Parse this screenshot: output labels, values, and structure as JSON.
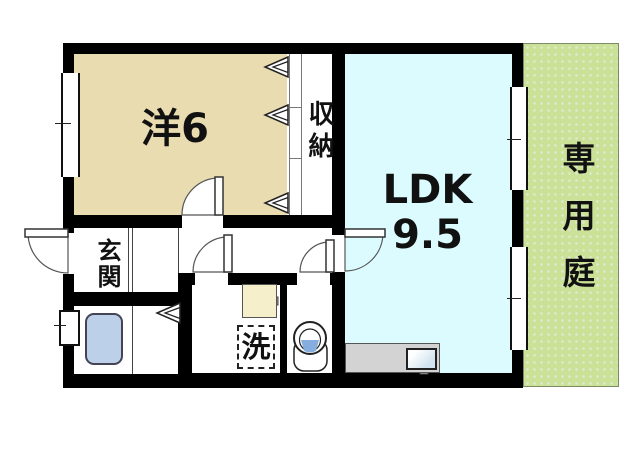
{
  "title": "apartment-floor-plan",
  "colors": {
    "wall": "#000000",
    "western": "#e9dcb0",
    "ldk": "#dcfbff",
    "garden": "#cbe197",
    "garden-dot": "#dcead0",
    "tub": "#bdd0ea",
    "counter": "#d3d3d3",
    "basin-bg": "#f6efcb",
    "water": "#85aede"
  },
  "rooms": {
    "western": {
      "label": "洋6"
    },
    "closet": {
      "label": "収納"
    },
    "ldk": {
      "label_line1": "LDK",
      "label_line2": "9.5"
    },
    "genkan": {
      "label": "玄関"
    },
    "laundry": {
      "label": "洗"
    },
    "garden": {
      "label": "専用庭"
    }
  }
}
